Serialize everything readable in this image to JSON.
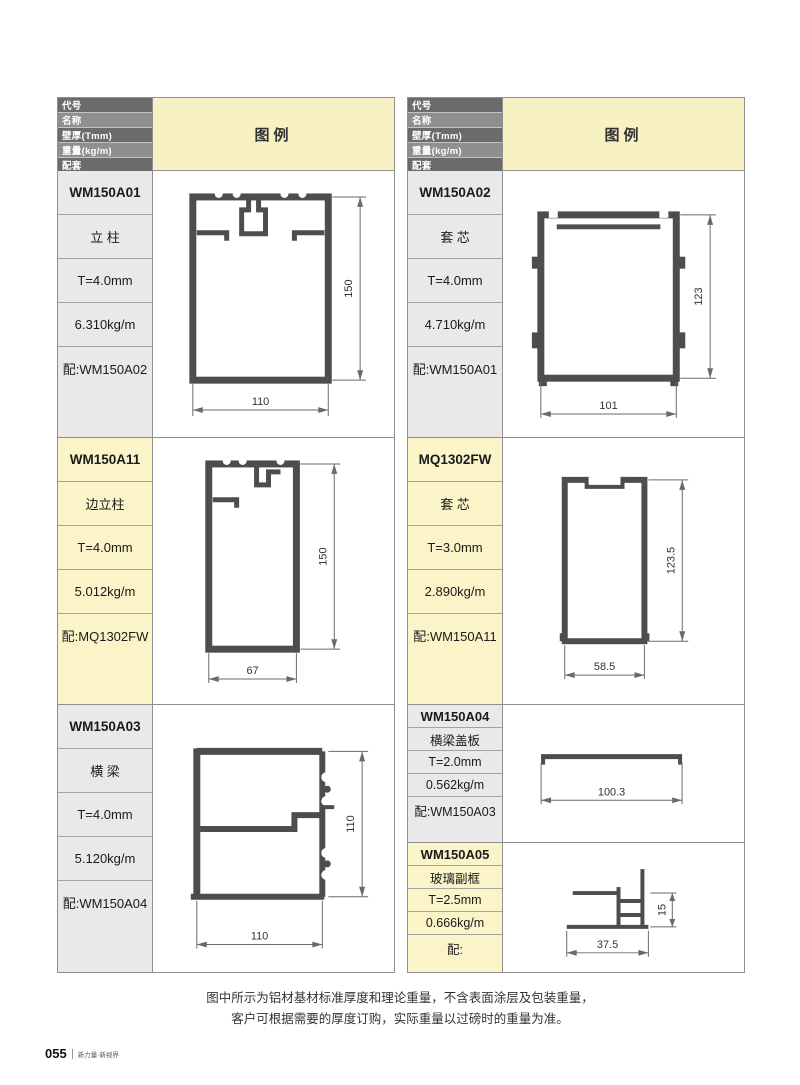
{
  "page": {
    "page_number": "055",
    "footer_brand": "新力量·新视界",
    "note_line1": "图中所示为铝材基材标准厚度和理论重量，不含表面涂层及包装重量，",
    "note_line2": "客户可根据需要的厚度订购，实际重量以过磅时的重量为准。"
  },
  "table_header": {
    "rows": [
      "代号",
      "名称",
      "壁厚(Tmm)",
      "重量(kg/m)",
      "配套"
    ],
    "legend_label": "图例"
  },
  "colors": {
    "header_dark": "#6b6b6b",
    "header_mid": "#8f8f8f",
    "legend_bg": "#f8f1c3",
    "cell_gray": "#e9e9e9",
    "cell_cream": "#fbf4c9",
    "profile_stroke": "#4d4d4d",
    "dim_line": "#6a6a6a"
  },
  "profiles": [
    {
      "code": "WM150A01",
      "name": "立 柱",
      "thickness": "T=4.0mm",
      "weight": "6.310kg/m",
      "match": "配:WM150A02",
      "width_dim": "110",
      "height_dim": "150"
    },
    {
      "code": "WM150A02",
      "name": "套 芯",
      "thickness": "T=4.0mm",
      "weight": "4.710kg/m",
      "match": "配:WM150A01",
      "width_dim": "101",
      "height_dim": "123"
    },
    {
      "code": "WM150A11",
      "name": "边立柱",
      "thickness": "T=4.0mm",
      "weight": "5.012kg/m",
      "match": "配:MQ1302FW",
      "width_dim": "67",
      "height_dim": "150"
    },
    {
      "code": "MQ1302FW",
      "name": "套 芯",
      "thickness": "T=3.0mm",
      "weight": "2.890kg/m",
      "match": "配:WM150A11",
      "width_dim": "58.5",
      "height_dim": "123.5"
    },
    {
      "code": "WM150A03",
      "name": "横 梁",
      "thickness": "T=4.0mm",
      "weight": "5.120kg/m",
      "match": "配:WM150A04",
      "width_dim": "110",
      "height_dim": "110"
    },
    {
      "code": "WM150A04",
      "name": "横梁盖板",
      "thickness": "T=2.0mm",
      "weight": "0.562kg/m",
      "match": "配:WM150A03",
      "width_dim": "100.3",
      "height_dim": ""
    },
    {
      "code": "WM150A05",
      "name": "玻璃副框",
      "thickness": "T=2.5mm",
      "weight": "0.666kg/m",
      "match": "配:",
      "width_dim": "37.5",
      "height_dim": "15"
    }
  ]
}
